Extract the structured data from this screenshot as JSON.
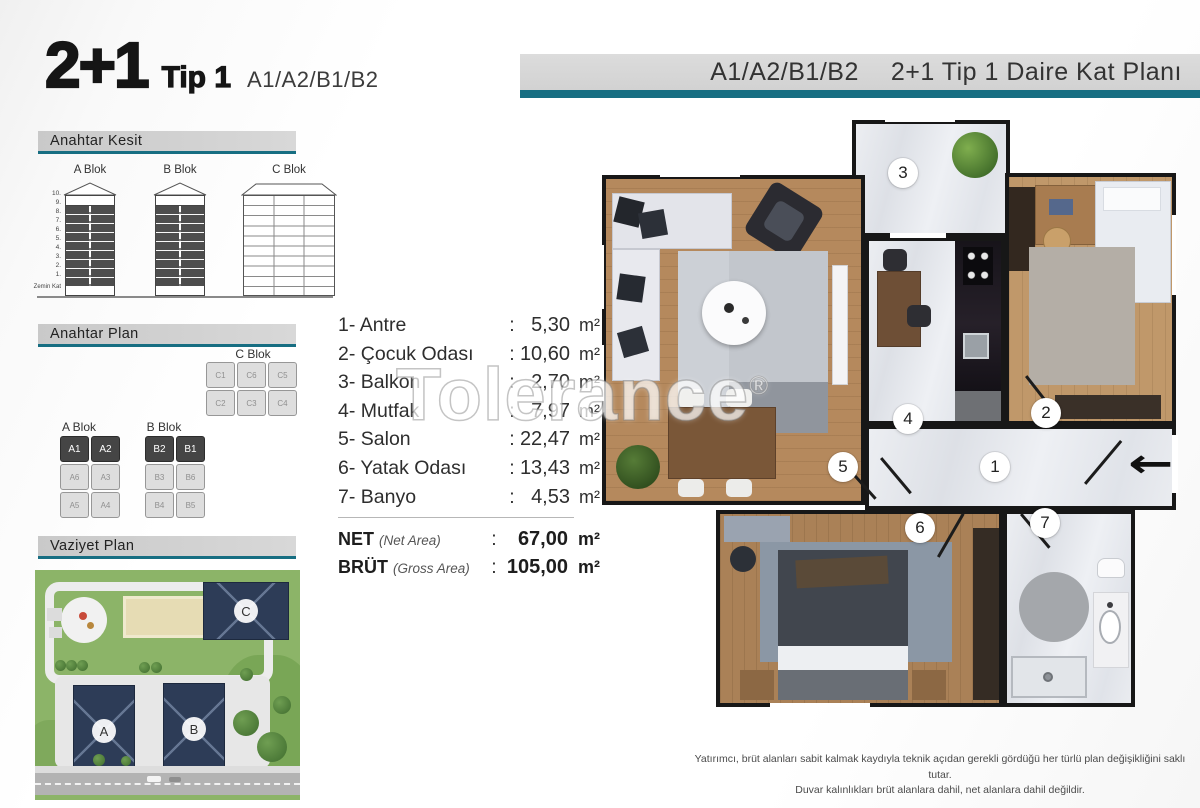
{
  "title": {
    "big": "2+1",
    "type": "Tip 1",
    "units": "A1/A2/B1/B2"
  },
  "header_bar": {
    "units": "A1/A2/B1/B2",
    "text": "2+1 Tip 1 Daire Kat Planı"
  },
  "colors": {
    "accent": "#176e82",
    "wall": "#171717",
    "site_building": "#2d3c57"
  },
  "watermark": {
    "text": "Tolerance",
    "reg": "®"
  },
  "kesit": {
    "title": "Anahtar Kesit",
    "block_a": "A Blok",
    "block_b": "B Blok",
    "block_c": "C Blok",
    "floors": [
      "10.",
      "9.",
      "8.",
      "7.",
      "6.",
      "5.",
      "4.",
      "3.",
      "2.",
      "1."
    ],
    "ground": "Zemin Kat"
  },
  "anahtar_plan": {
    "title": "Anahtar Plan",
    "c": {
      "label": "C Blok",
      "row1": [
        "C1",
        "C6",
        "C5"
      ],
      "row2": [
        "C2",
        "C3",
        "C4"
      ]
    },
    "a": {
      "label": "A Blok",
      "row1": [
        "A1",
        "A2"
      ],
      "row2": [
        "A6",
        "A3"
      ],
      "row3": [
        "A5",
        "A4"
      ]
    },
    "b": {
      "label": "B Blok",
      "row1": [
        "B2",
        "B1"
      ],
      "row2": [
        "B3",
        "B6"
      ],
      "row3": [
        "B4",
        "B5"
      ]
    }
  },
  "vaziyet": {
    "title": "Vaziyet Plan",
    "labels": {
      "a": "A",
      "b": "B",
      "c": "C"
    }
  },
  "room_list": {
    "rows": [
      {
        "no": "1-",
        "name": "Antre",
        "sep": ":",
        "value": "5,30",
        "unit": "m²"
      },
      {
        "no": "2-",
        "name": "Çocuk Odası",
        "sep": ":",
        "value": "10,60",
        "unit": "m²"
      },
      {
        "no": "3-",
        "name": "Balkon",
        "sep": ":",
        "value": "2,70",
        "unit": "m²"
      },
      {
        "no": "4-",
        "name": "Mutfak",
        "sep": ":",
        "value": "7,97",
        "unit": "m²"
      },
      {
        "no": "5-",
        "name": "Salon",
        "sep": ":",
        "value": "22,47",
        "unit": "m²"
      },
      {
        "no": "6-",
        "name": "Yatak Odası",
        "sep": ":",
        "value": "13,43",
        "unit": "m²"
      },
      {
        "no": "7-",
        "name": "Banyo",
        "sep": ":",
        "value": "4,53",
        "unit": "m²"
      }
    ],
    "net": {
      "label": "NET",
      "sub": "(Net Area)",
      "sep": ":",
      "value": "67,00",
      "unit": "m²"
    },
    "brut": {
      "label": "BRÜT",
      "sub": "(Gross Area)",
      "sep": ":",
      "value": "105,00",
      "unit": "m²"
    }
  },
  "plan": {
    "badges": {
      "b1": "1",
      "b2": "2",
      "b3": "3",
      "b4": "4",
      "b5": "5",
      "b6": "6",
      "b7": "7"
    },
    "entry_arrow": "←"
  },
  "disclaimer": {
    "line1": "Yatırımcı, brüt alanları sabit kalmak kaydıyla teknik açıdan gerekli gördüğü her türlü plan değişikliğini saklı tutar.",
    "line2": "Duvar kalınlıkları brüt alanlara dahil, net alanlara dahil değildir."
  }
}
